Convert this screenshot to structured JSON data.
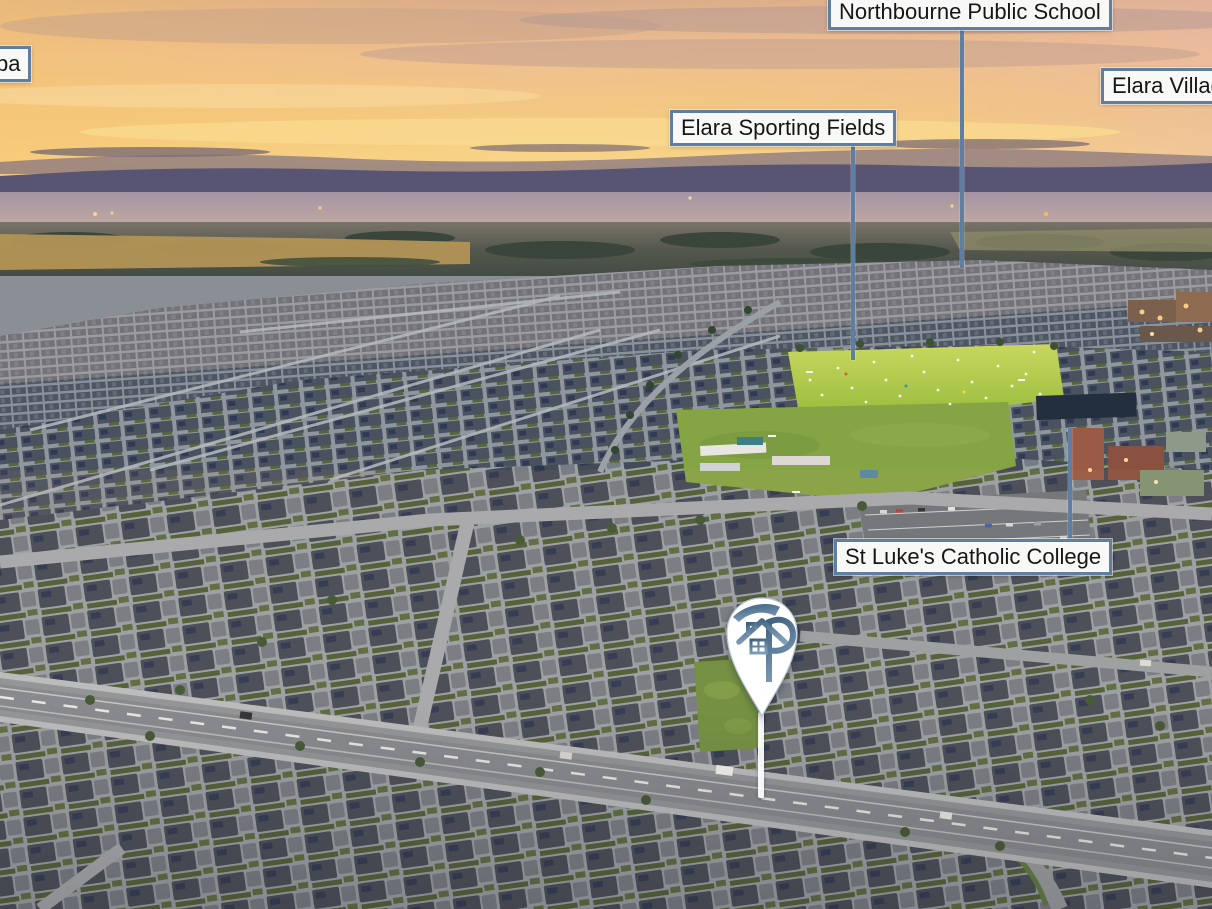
{
  "theme": {
    "accent": "#5e7fa2",
    "label_bg": "#f8f8f6",
    "label_text": "#161616",
    "pin_fill": "#ffffff",
    "pin_logo_dark": "#3f617f",
    "pin_logo_light": "#7d9cb8",
    "field_green": "#a9c548",
    "sky_gold": "#f5cb80"
  },
  "annotations": {
    "labels": {
      "partial_left": {
        "text": "ba"
      },
      "school": {
        "text": "Northbourne Public School"
      },
      "village": {
        "text": "Elara Village"
      },
      "fields": {
        "text": "Elara Sporting Fields"
      },
      "college": {
        "text": "St Luke's Catholic College"
      }
    }
  },
  "pin": {
    "icon": "house-p-monogram",
    "marker": "property-location-pin"
  }
}
